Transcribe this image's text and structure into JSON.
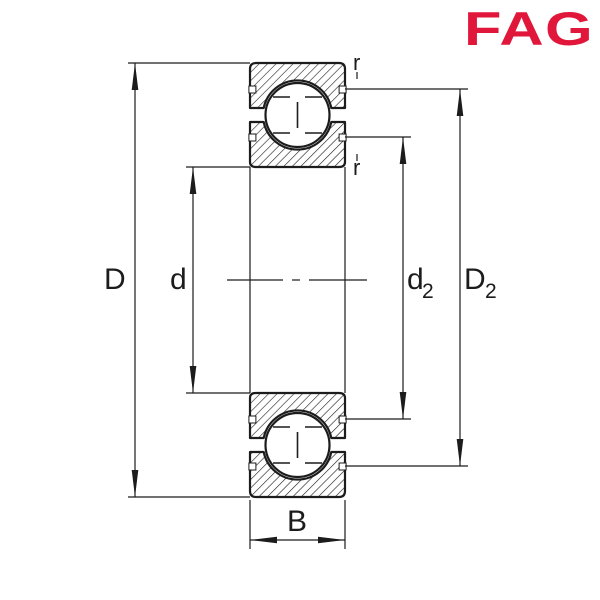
{
  "logo": {
    "text": "FAG",
    "color": "#E0173A"
  },
  "drawing": {
    "title": "Deep groove ball bearing cross-section",
    "line_color": "#1c1c1c",
    "background_color": "#ffffff",
    "labels": {
      "outer_diameter": {
        "base": "D"
      },
      "bore_diameter": {
        "base": "d"
      },
      "inner_shoulder_diameter": {
        "base": "d",
        "sub": "2"
      },
      "outer_shoulder_diameter": {
        "base": "D",
        "sub": "2"
      },
      "width": {
        "base": "B"
      },
      "chamfer_top": "r",
      "chamfer_bottom": "r"
    }
  }
}
